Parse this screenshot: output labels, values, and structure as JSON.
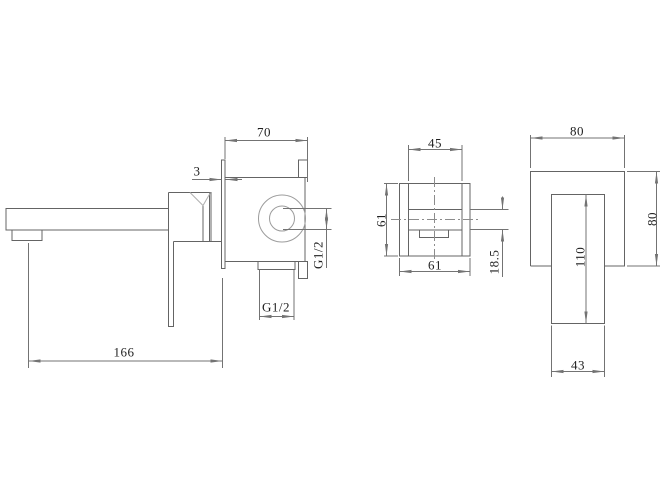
{
  "drawing": {
    "type": "technical-dimension-drawing",
    "subject": "wall-mounted single-lever basin mixer tap shown in three orthographic views",
    "background_color": "#ffffff",
    "line_color": "#646464",
    "dimension_line_color": "#737373",
    "text_color": "#1f1f1f",
    "views": [
      {
        "id": "side-view",
        "name": "side elevation with spout, lever and concealed valve body"
      },
      {
        "id": "front-view-body",
        "name": "front view of concealed valve body"
      },
      {
        "id": "front-view-plate",
        "name": "front view of wall plate with lever"
      }
    ],
    "dimensions": {
      "side": {
        "body_depth": "70",
        "plate_thickness": "3",
        "outlet_connection": "G1/2",
        "inlet_connection": "G1/2",
        "spout_projection": "166"
      },
      "body_front": {
        "cartridge_width": "45",
        "body_height": "61",
        "body_width": "61",
        "port_offset": "18.5"
      },
      "plate_front": {
        "plate_width": "80",
        "plate_height": "80",
        "lever_length": "110",
        "lever_width": "43"
      }
    }
  }
}
